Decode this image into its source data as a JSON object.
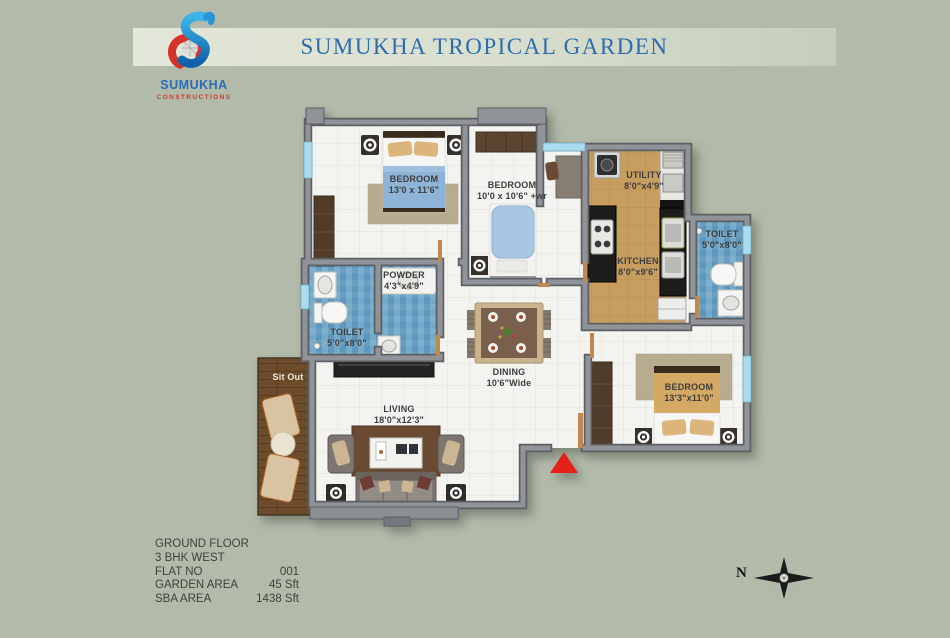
{
  "header": {
    "title": "SUMUKHA TROPICAL GARDEN"
  },
  "logo": {
    "name": "SUMUKHA",
    "subtitle": "CONSTRUCTIONS"
  },
  "rooms": {
    "bedroom1": {
      "name": "BEDROOM",
      "dims": "13'0 x 11'6\""
    },
    "bedroom2": {
      "name": "BEDROOM",
      "dims": "10'0 x 10'6\" +wr"
    },
    "bedroom3": {
      "name": "BEDROOM",
      "dims": "13'3\"x11'0\""
    },
    "utility": {
      "name": "UTILITY",
      "dims": "8'0\"x4'9\""
    },
    "kitchen": {
      "name": "KITCHEN",
      "dims": "8'0\"x9'6\""
    },
    "toilet_right": {
      "name": "TOILET",
      "dims": "5'0\"x8'0\""
    },
    "toilet_left": {
      "name": "TOILET",
      "dims": "5'0\"x8'0\""
    },
    "powder": {
      "name": "POWDER",
      "dims": "4'3\"x4'9\""
    },
    "dining": {
      "name": "DINING",
      "dims": "10'6\"Wide"
    },
    "living": {
      "name": "LIVING",
      "dims": "18'0\"x12'3\""
    },
    "sitout": {
      "name": "Sit Out"
    }
  },
  "info": {
    "rows": [
      {
        "label": "GROUND FLOOR",
        "value": ""
      },
      {
        "label": "3 BHK WEST",
        "value": ""
      },
      {
        "label": "FLAT NO",
        "value": "001"
      },
      {
        "label": "GARDEN AREA",
        "value": "45 Sft"
      },
      {
        "label": "SBA  AREA",
        "value": "1438 Sft"
      }
    ]
  },
  "compass": {
    "north_label": "N"
  },
  "colors": {
    "accent_blue": "#2a6db5",
    "accent_red": "#cb3a31",
    "entrance_marker": "#e4221a",
    "window_blue": "#a8dcee"
  }
}
